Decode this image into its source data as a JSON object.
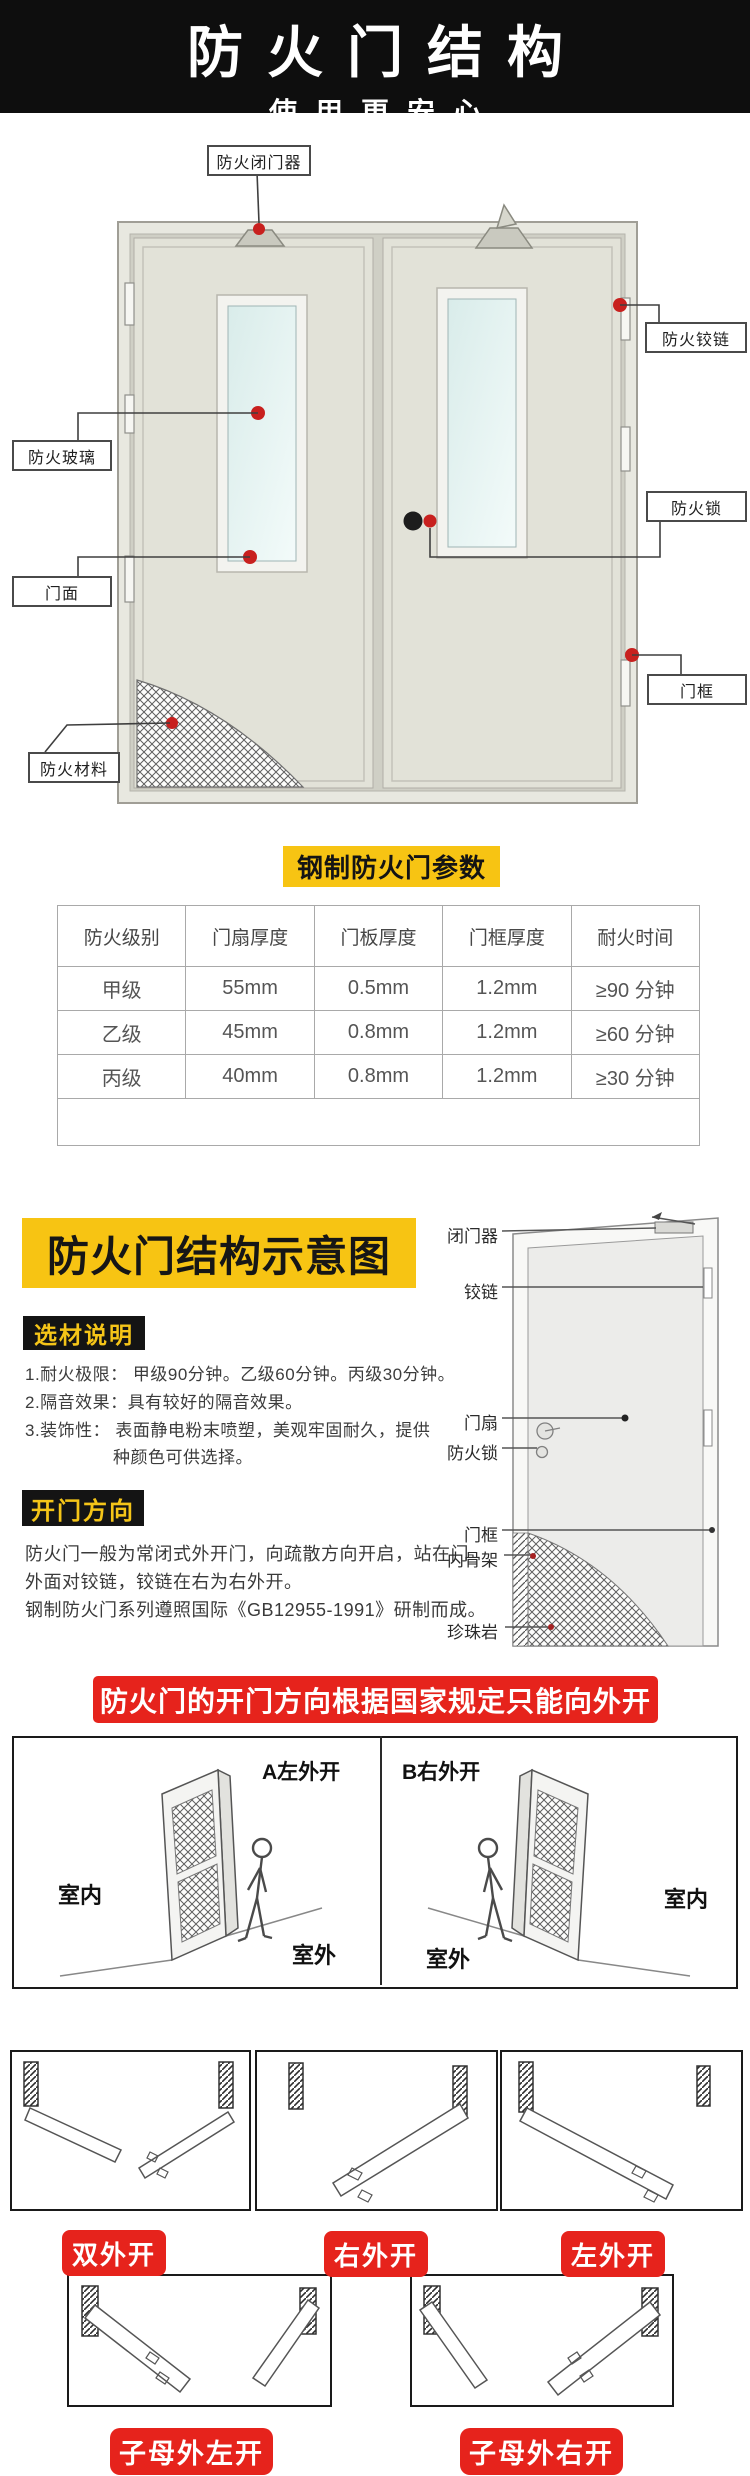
{
  "header": {
    "title": "防火门结构",
    "subtitle": "使用更安心"
  },
  "door_diagram": {
    "labels": {
      "closer": "防火闭门器",
      "hinge": "防火铰链",
      "glass": "防火玻璃",
      "face": "门面",
      "lock": "防火锁",
      "frame": "门框",
      "material": "防火材料"
    }
  },
  "params_table": {
    "title": "钢制防火门参数",
    "headers": [
      "防火级别",
      "门扇厚度",
      "门板厚度",
      "门框厚度",
      "耐火时间"
    ],
    "rows": [
      [
        "甲级",
        "55mm",
        "0.5mm",
        "1.2mm",
        "≥90 分钟"
      ],
      [
        "乙级",
        "45mm",
        "0.8mm",
        "1.2mm",
        "≥60 分钟"
      ],
      [
        "丙级",
        "40mm",
        "0.8mm",
        "1.2mm",
        "≥30 分钟"
      ]
    ]
  },
  "structure_section": {
    "title": "防火门结构示意图",
    "material_badge": "选材说明",
    "material_lines": [
      "1.耐火极限： 甲级90分钟。乙级60分钟。丙级30分钟。",
      "2.隔音效果：具有较好的隔音效果。",
      "3.装饰性：   表面静电粉末喷塑，美观牢固耐久，提供",
      "种颜色可供选择。"
    ],
    "direction_badge": "开门方向",
    "direction_lines": [
      "防火门一般为常闭式外开门，向疏散方向开启，站在门",
      "外面对铰链，铰链在右为右外开。",
      "钢制防火门系列遵照国际《GB12955-1991》研制而成。"
    ],
    "schematic": {
      "closer": "闭门器",
      "hinge": "铰链",
      "leaf": "门扇",
      "lock": "防火锁",
      "frame": "门框",
      "skeleton": "内骨架",
      "perlite": "珍珠岩"
    }
  },
  "direction_rule": {
    "banner": "防火门的开门方向根据国家规定只能向外开",
    "panel_a": {
      "label": "A左外开",
      "indoor": "室内",
      "outdoor": "室外"
    },
    "panel_b": {
      "label": "B右外开",
      "indoor": "室内",
      "outdoor": "室外"
    }
  },
  "opening_types": {
    "badges": [
      "双外开",
      "右外开",
      "左外开"
    ]
  },
  "double_leaf_types": {
    "badges": [
      "子母外左开",
      "子母外右开"
    ]
  },
  "colors": {
    "accent_yellow": "#f7c413",
    "accent_red": "#e6231c",
    "badge_black": "#141414"
  }
}
